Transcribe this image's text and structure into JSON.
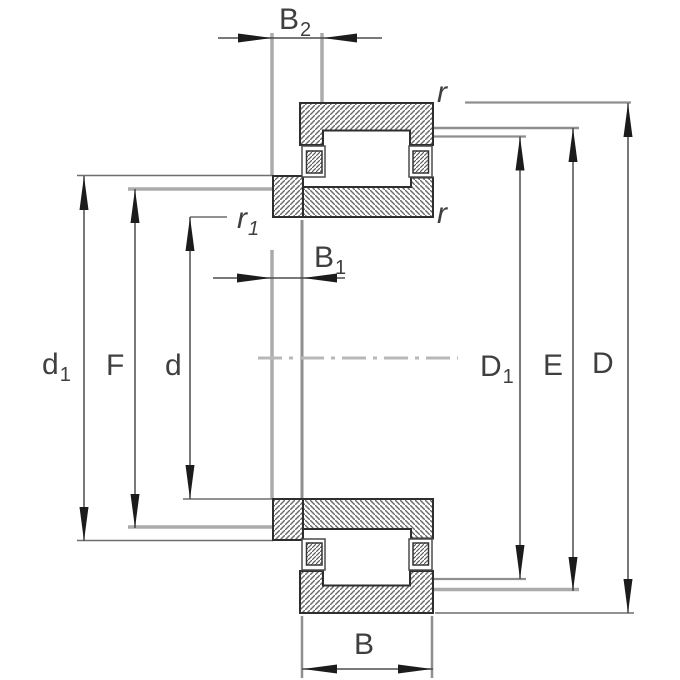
{
  "diagram": {
    "labels": {
      "B2": {
        "main": "B",
        "sub": "2"
      },
      "B1": {
        "main": "B",
        "sub": "1"
      },
      "r1": {
        "main": "r",
        "sub": "1"
      },
      "r_top": {
        "main": "r",
        "sub": ""
      },
      "r_mid": {
        "main": "r",
        "sub": ""
      },
      "d1": {
        "main": "d",
        "sub": "1"
      },
      "F": {
        "main": "F",
        "sub": ""
      },
      "d": {
        "main": "d",
        "sub": ""
      },
      "D1": {
        "main": "D",
        "sub": "1"
      },
      "E": {
        "main": "E",
        "sub": ""
      },
      "D": {
        "main": "D",
        "sub": ""
      },
      "B": {
        "main": "B",
        "sub": ""
      }
    },
    "colors": {
      "part_outline": "#2e2e2e",
      "hatch_stroke": "#6a6a6a",
      "dimension_line": "#4d4d4d",
      "extension_line_light": "#ababab",
      "extension_line_mid": "#8f8f8f",
      "arrowhead": "#1c1c1c",
      "centerline": "#b8b8b8",
      "label_text": "#3f3f3f",
      "background": "#ffffff"
    }
  }
}
